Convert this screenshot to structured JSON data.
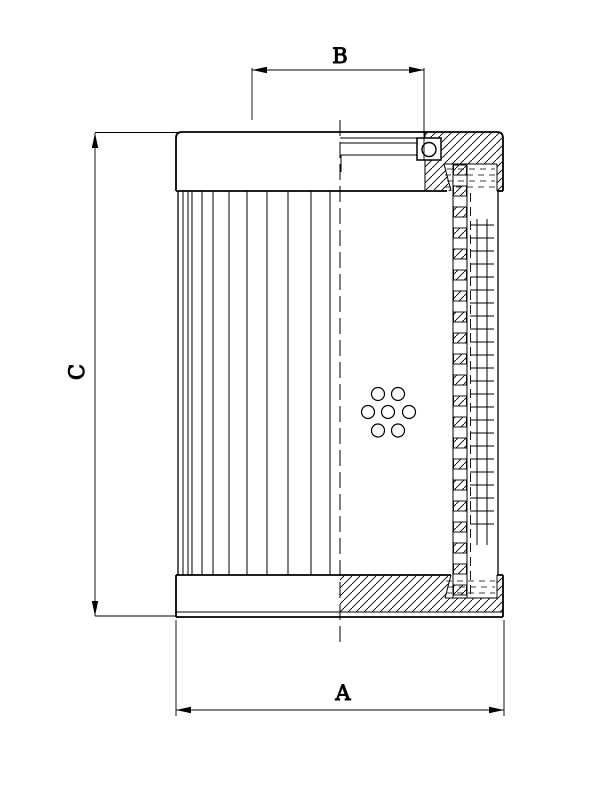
{
  "drawing": {
    "kind": "technical-drawing",
    "subject": "filter-element-half-section",
    "background_color": "#ffffff",
    "line_color": "#000000"
  },
  "dims": {
    "A": {
      "label": "A",
      "position": "bottom",
      "orientation": "horizontal"
    },
    "B": {
      "label": "B",
      "position": "top",
      "orientation": "horizontal"
    },
    "C": {
      "label": "C",
      "position": "left",
      "orientation": "vertical"
    }
  }
}
